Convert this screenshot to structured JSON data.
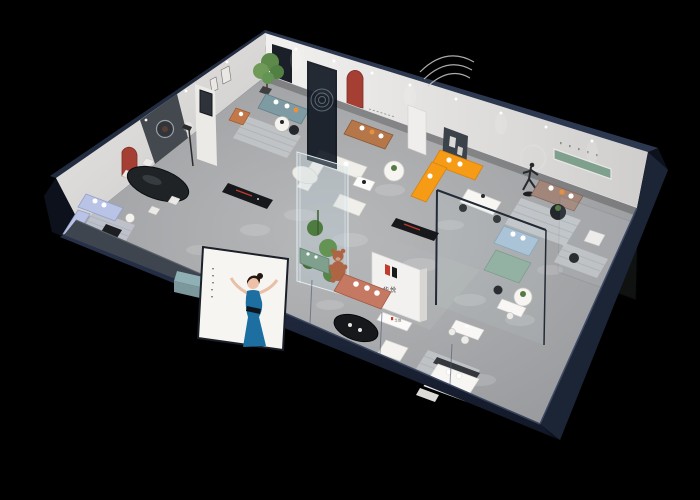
{
  "scene": {
    "title": "Isometric 3D cutaway render of a furniture showroom floor plan on black background",
    "background_color": "#000000",
    "brand": {
      "logo_mark": "N-shaped twin-stroke mark",
      "logo_text": "华悦",
      "logo_red": "#c23b2e",
      "logo_black": "#1a1a1a",
      "locations": [
        "center partition wall",
        "reception counter front"
      ]
    },
    "palette": {
      "outer_wall_navy": "#202b42",
      "outer_wall_dark": "#141b29",
      "right_wall_navy": "#1b2536",
      "roof_edge": "#2c3850",
      "inner_wall_white": "#efeeec",
      "inner_wall_shade": "#dddcd9",
      "floor_gray": "#a7a8ab",
      "accent_red_arch": "#a53f34",
      "sofa_teal": "#7e9aa2",
      "sofa_caramel": "#b5764a",
      "sofa_orange": "#f59b16",
      "sofa_brown": "#a3867a",
      "sofa_salmon": "#c57962",
      "sofa_periwinkle": "#b9c3e6",
      "sofa_mint": "#93b2a3",
      "sofa_bluegray": "#aac3d6",
      "sofa_cream": "#f1efe9",
      "console_black": "#16181c",
      "table_black": "#1f2326",
      "shelf_green": "#7fa08c",
      "plant_green": "#5d8a4a",
      "rug_gray": "#c6c9cc",
      "poster_bg": "#f6f5f2",
      "dress_blue": "#1c6fa0",
      "bear_brown": "#ad6544",
      "cube_teal": "#8fb0b5",
      "pillow_orange": "#e8903f",
      "front_wall_gray": "#3f454e"
    },
    "decor": {
      "shelf_lettering": "illegible spaced lettering above green recessed shelf",
      "wall_text": "two lines of illegible small wall text",
      "poster_caption": "vertical illegible caption on poster",
      "wall_motifs": [
        "curved triple-line relief",
        "ring light above runner sculpture",
        "etched circles on dark glass partition",
        "round artwork on dark panel"
      ]
    },
    "exterior": {
      "poster": "illustrated woman in blue dress gesturing on white board",
      "teal_ottoman_cube": "small teal cube seat outside facade"
    },
    "rooms": [
      {
        "name": "living-set-a",
        "furniture": [
          "cream modular sofa",
          "white coffee table",
          "black media console with red accent",
          "floor lamp",
          "black oval dining table",
          "white dining chairs",
          "curved cream chaise"
        ]
      },
      {
        "name": "teal-lounge",
        "furniture": [
          "teal fabric sofa with orange pillow",
          "terracotta accent armchair",
          "two round side tables",
          "potted tree",
          "striped gray rug"
        ]
      },
      {
        "name": "caramel-lounge",
        "furniture": [
          "caramel leather sofa",
          "white round display table with plant"
        ]
      },
      {
        "name": "orange-lounge",
        "furniture": [
          "orange L-shaped sectional sofa",
          "white marble dining table with black chairs",
          "dark gallery wall with framed art",
          "runner sculpture with ring light"
        ]
      },
      {
        "name": "brown-lounge",
        "furniture": [
          "brown fabric sofa",
          "striped rug",
          "black round table with plant",
          "green recessed wall shelf"
        ]
      },
      {
        "name": "glass-sofa-bed-room",
        "furniture": [
          "blue-gray sofa bed",
          "sage green seat",
          "white round table",
          "glass partition walls"
        ]
      },
      {
        "name": "far-right-bedroom",
        "furniture": [
          "white lounge chair",
          "striped rug",
          "side table"
        ]
      },
      {
        "name": "front-showroom",
        "furniture": [
          "salmon sofa",
          "black oval coffee table",
          "white ottoman",
          "reception counter with logo",
          "teddy bear sculpture",
          "green display cabinet",
          "black media bench",
          "white bed with dark headboard",
          "foot bench"
        ]
      },
      {
        "name": "periwinkle-room",
        "furniture": [
          "periwinkle sofa set",
          "black coffee table",
          "black TV console with red accent",
          "striped rug"
        ]
      },
      {
        "name": "office-corner",
        "furniture": [
          "two white desks",
          "white chairs"
        ]
      }
    ],
    "center_features": [
      "glass plant display tower",
      "dark etched glass partition",
      "white logo partition wall"
    ],
    "lighting": [
      "ceiling spotlights along walls",
      "circular light pools on gray floor"
    ]
  }
}
